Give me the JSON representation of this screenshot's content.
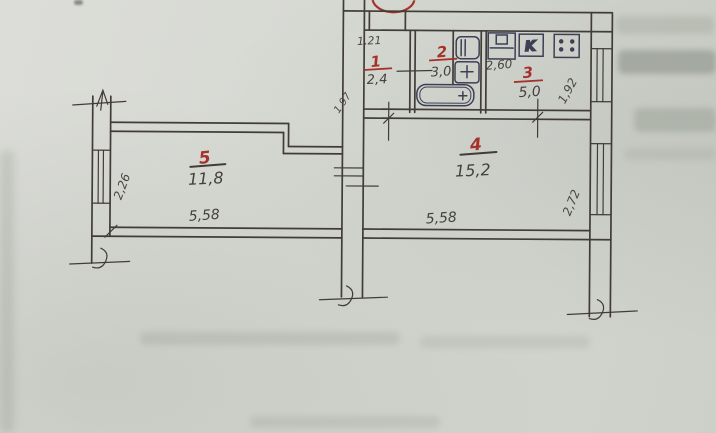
{
  "document": {
    "kind": "scanned hand-drawn apartment floor plan"
  },
  "rooms": [
    {
      "number": "1",
      "area": "2,4"
    },
    {
      "number": "2",
      "area": "3,0"
    },
    {
      "number": "3",
      "area": "5,0"
    },
    {
      "number": "4",
      "area": "15,2"
    },
    {
      "number": "5",
      "area": "11,8"
    }
  ],
  "dimensions": {
    "room1_top": "1.21",
    "hall_left_diag": "1,97",
    "kitchen_fixtures": "2,60",
    "kitchen_right_diag": "1,92",
    "room4_bottom": "5,58",
    "room4_right_diag": "2,72",
    "room5_bottom": "5,58",
    "room5_left_diag": "2,26"
  },
  "fixtures": {
    "water_heater_label": "K"
  },
  "colors": {
    "paper": "#d6d8d2",
    "pencil_ink": "#413d36",
    "red_marker": "#a5322c",
    "fixture_ink": "#3c4054"
  }
}
